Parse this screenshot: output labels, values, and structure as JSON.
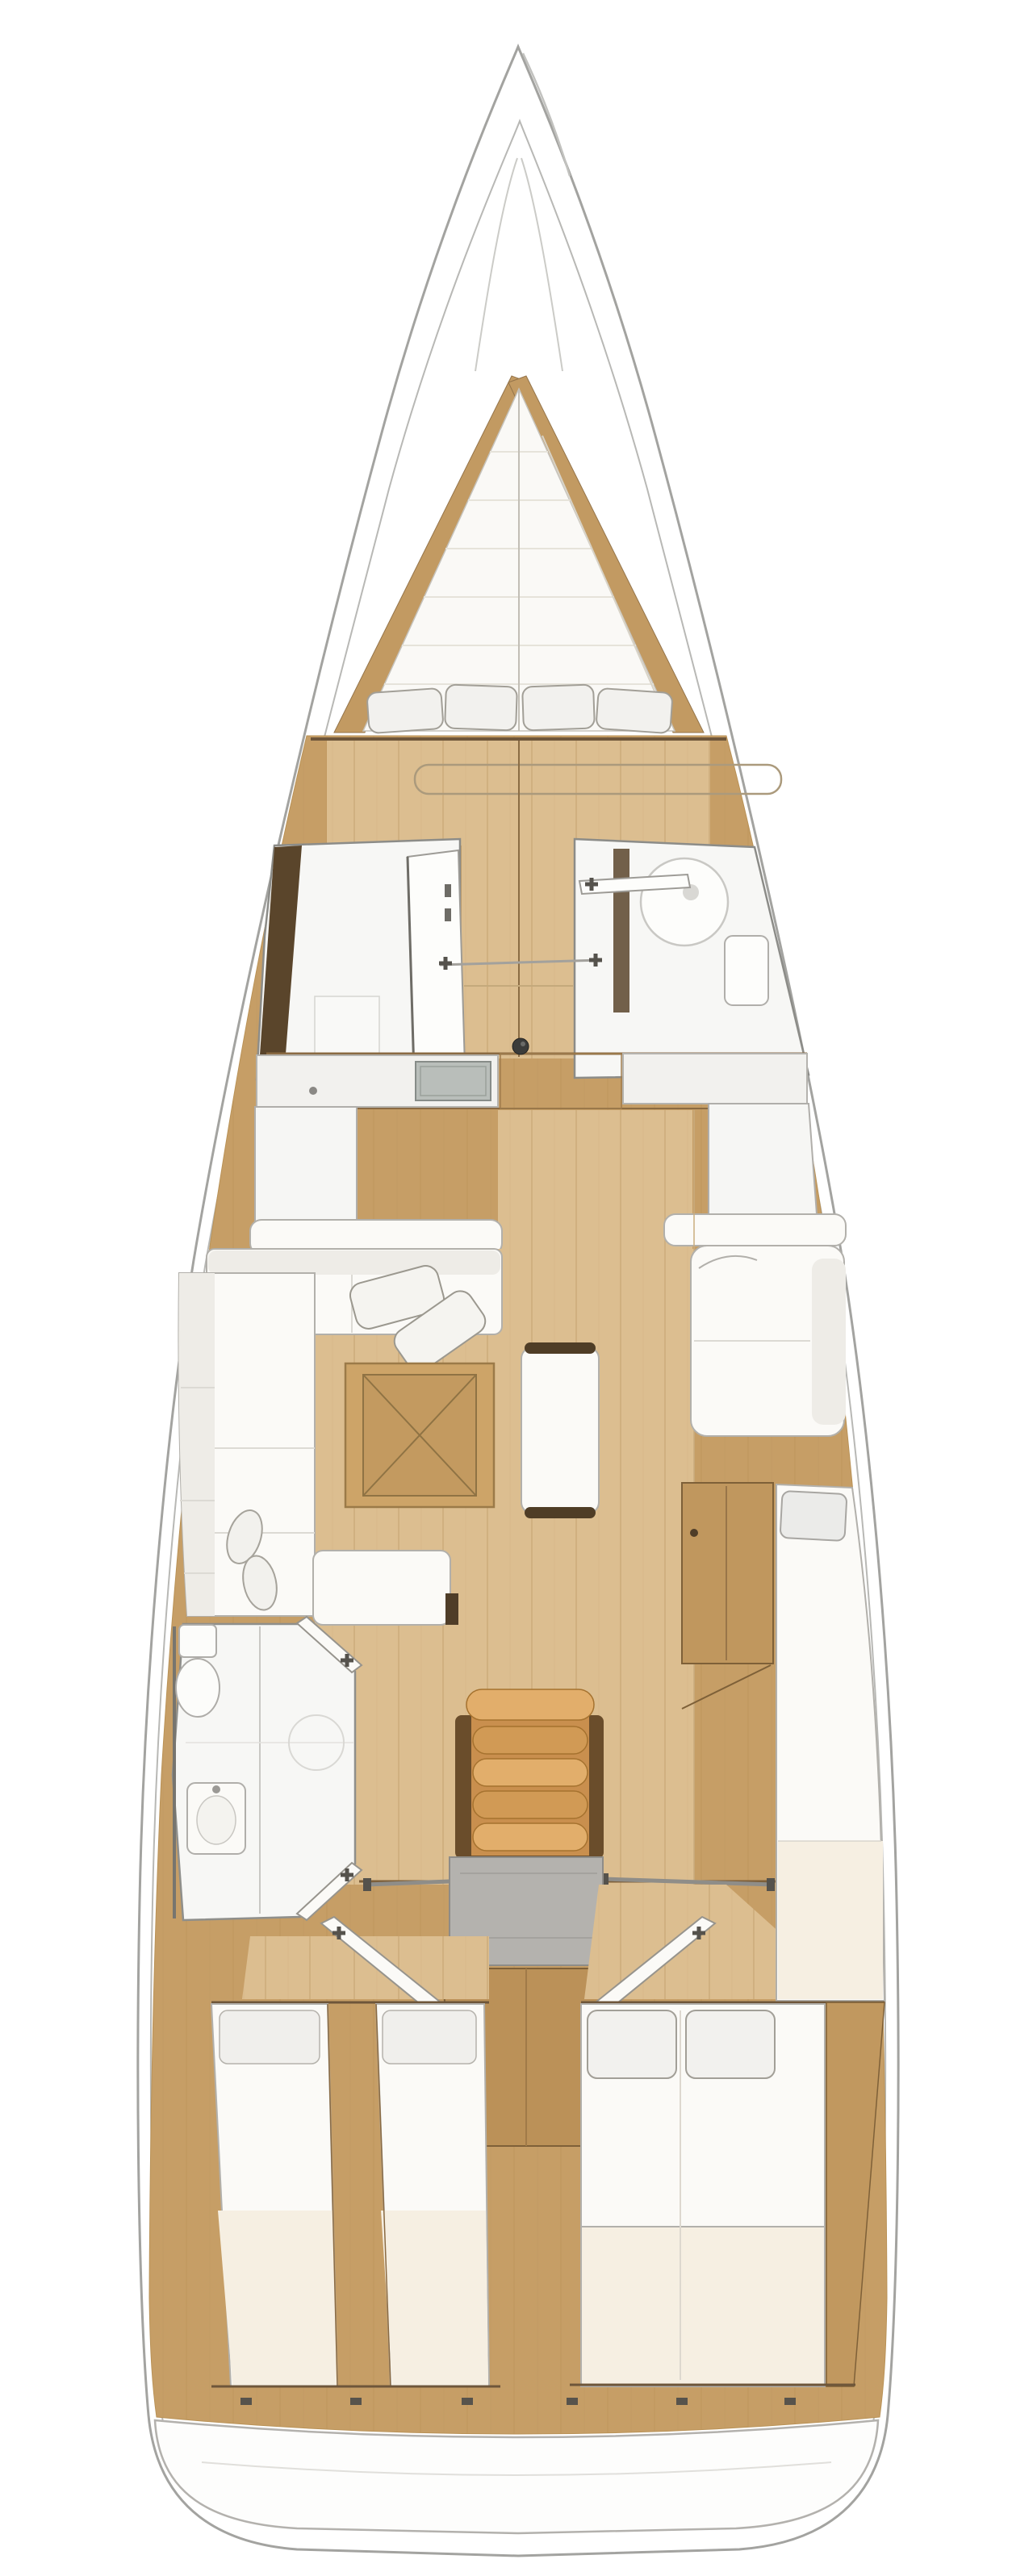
{
  "palette": {
    "bg": "#ffffff",
    "hull_fill": "#ffffff",
    "hull_stroke": "#a3a3a0",
    "inner_stroke": "#b8b8b5",
    "wood": "#c69e66",
    "wood_line": "#b99257",
    "wood_dark": "#7e6038",
    "trim_dark": "#5a452b",
    "floor": "#dcbe90",
    "floor_line": "#c9a877",
    "white_f": "#fbfaf7",
    "f_stroke": "#b2b0ab",
    "shadow_f": "#eeece7",
    "cream": "#f6efe2",
    "pillow": "#f2f1ee",
    "pillow_stroke": "#a29f97",
    "steps": "#d19a55",
    "steps_light": "#e2ae6b",
    "steps_dark": "#6a4d2b",
    "steps_edge": "#a5722f",
    "engine": "#b4b2ae",
    "sink": "#b9beba",
    "hardware": "#55524c",
    "knob": "#3c3c3a",
    "glass": "#c9c8c4",
    "table": "#cda468",
    "table_line": "#8f7344",
    "bench_cap": "#4f3d26",
    "stern_white": "#fdfdfc",
    "quilt": "#e6e3da",
    "rail": "#8f8d88"
  },
  "plan": {
    "type": "sailing-yacht-interior-deck-plan",
    "orientation": "bow-up",
    "companionway_step_count": 5,
    "vberth_pillow_count": 4,
    "aft_double_pillow_count": 2
  },
  "rooms": {
    "bow_locker": "Bow anchor locker",
    "forward_cabin": "Forward cabin with V-berth",
    "forward_head_port": "Forward head compartment (port)",
    "forward_head_starboard": "Forward head with shower basin (starboard)",
    "galley_port": "Galley counter with sink (port)",
    "galley_starboard": "Counter unit (starboard)",
    "saloon": "Saloon with L-shaped sofa, folding table and centre bench",
    "aft_head_port": "Aft head with toilet, basin and shower (port)",
    "companionway": "Companionway steps over engine compartment",
    "aft_cabin_port": "Aft cabin with twin berths (port)",
    "aft_cabin_starboard": "Aft cabin with double berth (starboard)",
    "stern": "Stern transom platform"
  }
}
